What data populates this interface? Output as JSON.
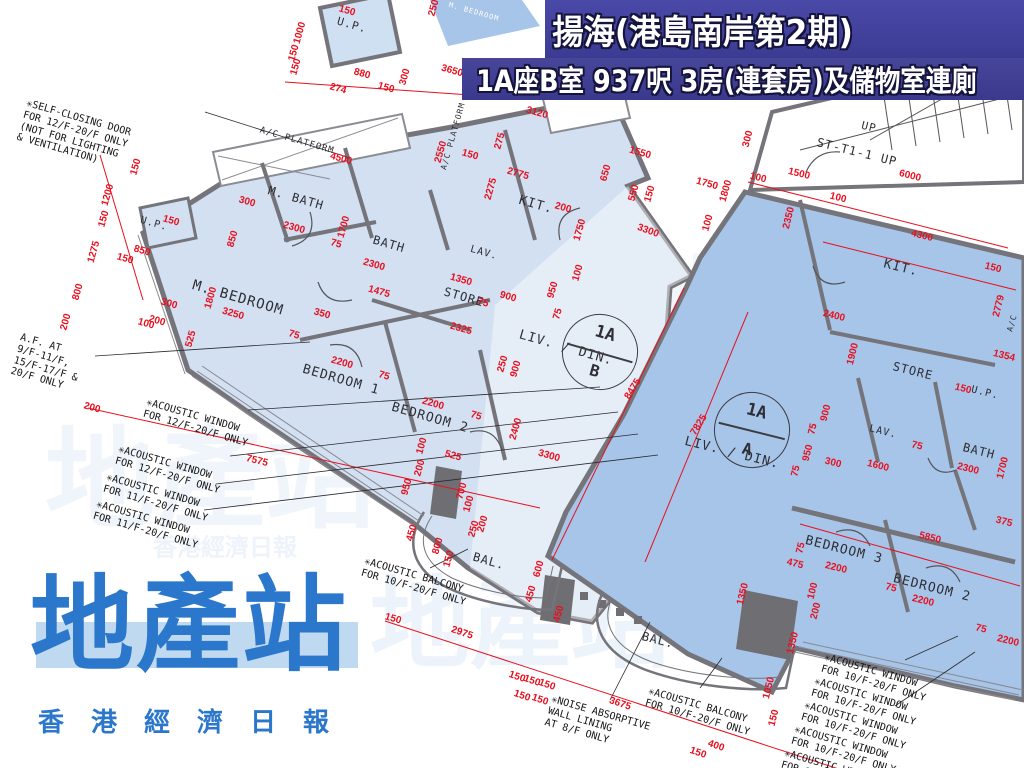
{
  "banner": {
    "title_line1": "揚海(港島南岸第2期)",
    "title_line2": "1A座B室 937呎 3房(連套房)及儲物室連廁"
  },
  "logo": {
    "name": "地產站",
    "tagline": "香港經濟日報"
  },
  "colors": {
    "banner_bg": "#44439c",
    "dimension_red": "#e8101e",
    "wall_gray": "#74747a",
    "unit_b_fill": "#d2e0f2",
    "unit_a_fill": "#a6c5e8",
    "logo_blue": "#2b77cb"
  },
  "unit_circles": [
    {
      "line1": "1A",
      "line2": "B",
      "x": 600,
      "y": 352,
      "r": 16
    },
    {
      "line1": "1A",
      "line2": "A",
      "x": 752,
      "y": 430,
      "r": 14
    }
  ],
  "rooms": [
    {
      "label": "U.P.",
      "x": 352,
      "y": 25,
      "r": 16,
      "s": 11
    },
    {
      "label": "A/C PLATFORM",
      "x": 297,
      "y": 141,
      "r": 16,
      "s": 9
    },
    {
      "label": "A/C PLATFORM",
      "x": 453,
      "y": 136,
      "r": -74,
      "s": 8
    },
    {
      "label": "M. BATH",
      "x": 296,
      "y": 198,
      "r": 16,
      "s": 12
    },
    {
      "label": "KIT.",
      "x": 536,
      "y": 205,
      "r": 16,
      "s": 13
    },
    {
      "label": "BATH",
      "x": 389,
      "y": 244,
      "r": 16,
      "s": 12
    },
    {
      "label": "LAV.",
      "x": 484,
      "y": 253,
      "r": 16,
      "s": 10
    },
    {
      "label": "STORE",
      "x": 464,
      "y": 297,
      "r": 16,
      "s": 12
    },
    {
      "label": "M. BEDROOM",
      "x": 238,
      "y": 298,
      "r": 16,
      "s": 14
    },
    {
      "label": "BEDROOM 1",
      "x": 341,
      "y": 380,
      "r": 16,
      "s": 13
    },
    {
      "label": "BEDROOM 2",
      "x": 430,
      "y": 418,
      "r": 16,
      "s": 13
    },
    {
      "label": "LIV. / DIN.",
      "x": 566,
      "y": 348,
      "r": 16,
      "s": 13
    },
    {
      "label": "BAL.",
      "x": 489,
      "y": 561,
      "r": 16,
      "s": 12
    },
    {
      "label": "U.P.",
      "x": 154,
      "y": 224,
      "r": 16,
      "s": 10
    },
    {
      "label": "UP",
      "x": 869,
      "y": 127,
      "r": 14,
      "s": 11
    },
    {
      "label": "ST-T1-1 UP",
      "x": 857,
      "y": 152,
      "r": 14,
      "s": 12
    },
    {
      "label": "KIT.",
      "x": 901,
      "y": 268,
      "r": 14,
      "s": 13
    },
    {
      "label": "STORE",
      "x": 913,
      "y": 371,
      "r": 14,
      "s": 12
    },
    {
      "label": "LAV.",
      "x": 883,
      "y": 432,
      "r": 14,
      "s": 10
    },
    {
      "label": "U.P.",
      "x": 985,
      "y": 393,
      "r": 14,
      "s": 10
    },
    {
      "label": "BATH",
      "x": 979,
      "y": 451,
      "r": 14,
      "s": 12
    },
    {
      "label": "BEDROOM 3",
      "x": 844,
      "y": 550,
      "r": 14,
      "s": 13
    },
    {
      "label": "BEDROOM 2",
      "x": 932,
      "y": 588,
      "r": 14,
      "s": 13
    },
    {
      "label": "LIV. / DIN.",
      "x": 732,
      "y": 453,
      "r": 14,
      "s": 13
    },
    {
      "label": "BAL.",
      "x": 658,
      "y": 640,
      "r": 14,
      "s": 12
    },
    {
      "label": "A/C",
      "x": 1012,
      "y": 323,
      "r": -74,
      "s": 8
    },
    {
      "label": "M. BEDROOM",
      "x": 474,
      "y": 12,
      "r": 16,
      "s": 7,
      "c": "#ffffff"
    }
  ],
  "annotations": [
    {
      "text": "✳SELF-CLOSING DOOR\nFOR 12/F-20/F ONLY\n(NOT FOR LIGHTING\n& VENTILATION)",
      "x": 28,
      "y": 98,
      "r": 16
    },
    {
      "text": "A.F. AT\n9/F-11/F,\n15/F-17/F &\n20/F ONLY",
      "x": 22,
      "y": 332,
      "r": 16
    },
    {
      "text": "✳ACOUSTIC WINDOW\nFOR 12/F-20/F ONLY",
      "x": 148,
      "y": 397,
      "r": 16
    },
    {
      "text": "✳ACOUSTIC WINDOW\nFOR 12/F-20/F ONLY",
      "x": 120,
      "y": 444,
      "r": 16
    },
    {
      "text": "✳ACOUSTIC WINDOW\nFOR 11/F-20/F ONLY",
      "x": 108,
      "y": 472,
      "r": 16
    },
    {
      "text": "✳ACOUSTIC WINDOW\nFOR 11/F-20/F ONLY",
      "x": 98,
      "y": 499,
      "r": 16
    },
    {
      "text": "✳ACOUSTIC BALCONY\nFOR 10/F-20/F ONLY",
      "x": 366,
      "y": 556,
      "r": 16
    },
    {
      "text": "✳NOISE ABSORPTIVE\nWALL LINING\nAT 8/F ONLY",
      "x": 553,
      "y": 694,
      "r": 16
    },
    {
      "text": "✳ACOUSTIC BALCONY\nFOR 10/F-20/F ONLY",
      "x": 650,
      "y": 686,
      "r": 16
    },
    {
      "text": "✳ACOUSTIC WINDOW\nFOR 10/F-20/F ONLY",
      "x": 826,
      "y": 652,
      "r": 16
    },
    {
      "text": "✳ACOUSTIC WINDOW\nFOR 10/F-20/F ONLY",
      "x": 816,
      "y": 676,
      "r": 16
    },
    {
      "text": "✳ACOUSTIC WINDOW\nFOR 10/F-20/F ONLY",
      "x": 806,
      "y": 700,
      "r": 16
    },
    {
      "text": "✳ACOUSTIC WINDOW\nFOR 10/F-20/F ONLY",
      "x": 796,
      "y": 724,
      "r": 16
    },
    {
      "text": "✳ACOUSTIC WINDOW\nFOR 10/F-20/F ONLY",
      "x": 786,
      "y": 748,
      "r": 16
    }
  ],
  "dims": [
    {
      "t": "150",
      "x": 347,
      "y": 11,
      "r": 16
    },
    {
      "t": "250",
      "x": 434,
      "y": 8,
      "r": -74
    },
    {
      "t": "1000",
      "x": 300,
      "y": 33,
      "r": -74
    },
    {
      "t": "150",
      "x": 294,
      "y": 53,
      "r": -74
    },
    {
      "t": "150",
      "x": 296,
      "y": 67,
      "r": -74
    },
    {
      "t": "880",
      "x": 362,
      "y": 74,
      "r": 16
    },
    {
      "t": "274",
      "x": 338,
      "y": 89,
      "r": 16
    },
    {
      "t": "150",
      "x": 386,
      "y": 88,
      "r": 16
    },
    {
      "t": "300",
      "x": 405,
      "y": 77,
      "r": -74
    },
    {
      "t": "3650",
      "x": 452,
      "y": 71,
      "r": 16
    },
    {
      "t": "2550",
      "x": 441,
      "y": 152,
      "r": -74
    },
    {
      "t": "4500",
      "x": 341,
      "y": 159,
      "r": 16
    },
    {
      "t": "3120",
      "x": 537,
      "y": 113,
      "r": 16
    },
    {
      "t": "150",
      "x": 470,
      "y": 155,
      "r": 16
    },
    {
      "t": "275",
      "x": 500,
      "y": 141,
      "r": -74
    },
    {
      "t": "2775",
      "x": 518,
      "y": 174,
      "r": 16
    },
    {
      "t": "2275",
      "x": 491,
      "y": 189,
      "r": -74
    },
    {
      "t": "1550",
      "x": 640,
      "y": 153,
      "r": 16
    },
    {
      "t": "650",
      "x": 606,
      "y": 173,
      "r": -74
    },
    {
      "t": "550",
      "x": 634,
      "y": 193,
      "r": -74
    },
    {
      "t": "150",
      "x": 650,
      "y": 194,
      "r": -74
    },
    {
      "t": "1750",
      "x": 707,
      "y": 184,
      "r": 16
    },
    {
      "t": "1800",
      "x": 726,
      "y": 191,
      "r": -74
    },
    {
      "t": "100",
      "x": 708,
      "y": 223,
      "r": -74
    },
    {
      "t": "3300",
      "x": 648,
      "y": 231,
      "r": 20
    },
    {
      "t": "200",
      "x": 563,
      "y": 208,
      "r": 16
    },
    {
      "t": "1750",
      "x": 580,
      "y": 230,
      "r": -74
    },
    {
      "t": "150",
      "x": 136,
      "y": 167,
      "r": -74
    },
    {
      "t": "1200",
      "x": 108,
      "y": 195,
      "r": -74
    },
    {
      "t": "150",
      "x": 104,
      "y": 219,
      "r": -74
    },
    {
      "t": "1275",
      "x": 94,
      "y": 252,
      "r": -74
    },
    {
      "t": "800",
      "x": 78,
      "y": 292,
      "r": -74
    },
    {
      "t": "850",
      "x": 142,
      "y": 251,
      "r": 16
    },
    {
      "t": "150",
      "x": 125,
      "y": 259,
      "r": 16
    },
    {
      "t": "150",
      "x": 171,
      "y": 221,
      "r": 16
    },
    {
      "t": "200",
      "x": 66,
      "y": 322,
      "r": -74
    },
    {
      "t": "300",
      "x": 169,
      "y": 304,
      "r": 16
    },
    {
      "t": "200",
      "x": 157,
      "y": 321,
      "r": 16
    },
    {
      "t": "100",
      "x": 146,
      "y": 324,
      "r": 16
    },
    {
      "t": "200",
      "x": 92,
      "y": 408,
      "r": 16
    },
    {
      "t": "7575",
      "x": 257,
      "y": 461,
      "r": 14
    },
    {
      "t": "850",
      "x": 233,
      "y": 239,
      "r": -74
    },
    {
      "t": "300",
      "x": 247,
      "y": 202,
      "r": 16
    },
    {
      "t": "2300",
      "x": 294,
      "y": 228,
      "r": 16
    },
    {
      "t": "1700",
      "x": 344,
      "y": 227,
      "r": -74
    },
    {
      "t": "75",
      "x": 336,
      "y": 244,
      "r": 16
    },
    {
      "t": "2300",
      "x": 374,
      "y": 265,
      "r": 16
    },
    {
      "t": "1475",
      "x": 379,
      "y": 292,
      "r": 16
    },
    {
      "t": "3250",
      "x": 233,
      "y": 314,
      "r": 16
    },
    {
      "t": "1800",
      "x": 211,
      "y": 298,
      "r": -74
    },
    {
      "t": "525",
      "x": 191,
      "y": 339,
      "r": -74
    },
    {
      "t": "350",
      "x": 322,
      "y": 314,
      "r": 16
    },
    {
      "t": "75",
      "x": 294,
      "y": 335,
      "r": 16
    },
    {
      "t": "1350",
      "x": 461,
      "y": 280,
      "r": 16
    },
    {
      "t": "75",
      "x": 483,
      "y": 303,
      "r": 16
    },
    {
      "t": "900",
      "x": 508,
      "y": 297,
      "r": 16
    },
    {
      "t": "2325",
      "x": 461,
      "y": 329,
      "r": 16
    },
    {
      "t": "950",
      "x": 553,
      "y": 290,
      "r": -74
    },
    {
      "t": "75",
      "x": 558,
      "y": 314,
      "r": -74
    },
    {
      "t": "100",
      "x": 578,
      "y": 273,
      "r": -74
    },
    {
      "t": "2200",
      "x": 342,
      "y": 363,
      "r": 16
    },
    {
      "t": "75",
      "x": 384,
      "y": 376,
      "r": 16
    },
    {
      "t": "2200",
      "x": 433,
      "y": 404,
      "r": 16
    },
    {
      "t": "75",
      "x": 476,
      "y": 416,
      "r": 16
    },
    {
      "t": "250",
      "x": 503,
      "y": 364,
      "r": -74
    },
    {
      "t": "900",
      "x": 516,
      "y": 369,
      "r": -74
    },
    {
      "t": "2400",
      "x": 516,
      "y": 429,
      "r": -74
    },
    {
      "t": "525",
      "x": 453,
      "y": 456,
      "r": 16
    },
    {
      "t": "100",
      "x": 422,
      "y": 446,
      "r": -74
    },
    {
      "t": "200",
      "x": 420,
      "y": 468,
      "r": -74
    },
    {
      "t": "950",
      "x": 407,
      "y": 487,
      "r": -74
    },
    {
      "t": "700",
      "x": 462,
      "y": 491,
      "r": -74
    },
    {
      "t": "100",
      "x": 469,
      "y": 504,
      "r": -74
    },
    {
      "t": "8475",
      "x": 633,
      "y": 389,
      "r": -58
    },
    {
      "t": "7825",
      "x": 699,
      "y": 425,
      "r": -58
    },
    {
      "t": "3300",
      "x": 549,
      "y": 456,
      "r": 16
    },
    {
      "t": "450",
      "x": 412,
      "y": 533,
      "r": -74
    },
    {
      "t": "800",
      "x": 438,
      "y": 546,
      "r": -74
    },
    {
      "t": "150",
      "x": 449,
      "y": 559,
      "r": -74
    },
    {
      "t": "250",
      "x": 474,
      "y": 529,
      "r": -74
    },
    {
      "t": "200",
      "x": 483,
      "y": 524,
      "r": -74
    },
    {
      "t": "600",
      "x": 539,
      "y": 569,
      "r": -74
    },
    {
      "t": "450",
      "x": 531,
      "y": 594,
      "r": -74
    },
    {
      "t": "450",
      "x": 559,
      "y": 614,
      "r": -74
    },
    {
      "t": "150",
      "x": 393,
      "y": 619,
      "r": 16
    },
    {
      "t": "2975",
      "x": 462,
      "y": 633,
      "r": 19
    },
    {
      "t": "150",
      "x": 517,
      "y": 677,
      "r": 19
    },
    {
      "t": "150",
      "x": 532,
      "y": 681,
      "r": 19
    },
    {
      "t": "150",
      "x": 547,
      "y": 685,
      "r": 19
    },
    {
      "t": "150",
      "x": 522,
      "y": 696,
      "r": 19
    },
    {
      "t": "150",
      "x": 540,
      "y": 700,
      "r": 19
    },
    {
      "t": "3675",
      "x": 620,
      "y": 704,
      "r": 19
    },
    {
      "t": "400",
      "x": 716,
      "y": 746,
      "r": 19
    },
    {
      "t": "150",
      "x": 698,
      "y": 753,
      "r": 19
    },
    {
      "t": "300",
      "x": 748,
      "y": 139,
      "r": -76
    },
    {
      "t": "100",
      "x": 758,
      "y": 178,
      "r": 14
    },
    {
      "t": "1500",
      "x": 799,
      "y": 174,
      "r": 14
    },
    {
      "t": "6000",
      "x": 910,
      "y": 176,
      "r": 14
    },
    {
      "t": "100",
      "x": 838,
      "y": 198,
      "r": 14
    },
    {
      "t": "2350",
      "x": 789,
      "y": 218,
      "r": -76
    },
    {
      "t": "4300",
      "x": 922,
      "y": 236,
      "r": 14
    },
    {
      "t": "150",
      "x": 993,
      "y": 268,
      "r": 14
    },
    {
      "t": "2779",
      "x": 999,
      "y": 306,
      "r": -76
    },
    {
      "t": "1354",
      "x": 1004,
      "y": 356,
      "r": 14
    },
    {
      "t": "2400",
      "x": 834,
      "y": 316,
      "r": 14
    },
    {
      "t": "1900",
      "x": 853,
      "y": 354,
      "r": -76
    },
    {
      "t": "150",
      "x": 963,
      "y": 389,
      "r": 14
    },
    {
      "t": "900",
      "x": 826,
      "y": 413,
      "r": -76
    },
    {
      "t": "75",
      "x": 813,
      "y": 429,
      "r": -76
    },
    {
      "t": "950",
      "x": 808,
      "y": 453,
      "r": -76
    },
    {
      "t": "75",
      "x": 796,
      "y": 471,
      "r": -76
    },
    {
      "t": "300",
      "x": 833,
      "y": 463,
      "r": 14
    },
    {
      "t": "1600",
      "x": 878,
      "y": 466,
      "r": 14
    },
    {
      "t": "75",
      "x": 917,
      "y": 446,
      "r": 14
    },
    {
      "t": "2300",
      "x": 968,
      "y": 469,
      "r": 14
    },
    {
      "t": "1700",
      "x": 1003,
      "y": 468,
      "r": -76
    },
    {
      "t": "375",
      "x": 1004,
      "y": 522,
      "r": 14
    },
    {
      "t": "5850",
      "x": 930,
      "y": 538,
      "r": 14
    },
    {
      "t": "75",
      "x": 801,
      "y": 548,
      "r": -76
    },
    {
      "t": "2200",
      "x": 836,
      "y": 568,
      "r": 14
    },
    {
      "t": "475",
      "x": 795,
      "y": 564,
      "r": 14
    },
    {
      "t": "75",
      "x": 891,
      "y": 588,
      "r": 14
    },
    {
      "t": "2200",
      "x": 923,
      "y": 601,
      "r": 14
    },
    {
      "t": "75",
      "x": 981,
      "y": 629,
      "r": 14
    },
    {
      "t": "2200",
      "x": 1008,
      "y": 641,
      "r": 14
    },
    {
      "t": "1350",
      "x": 743,
      "y": 594,
      "r": -76
    },
    {
      "t": "100",
      "x": 813,
      "y": 591,
      "r": -76
    },
    {
      "t": "200",
      "x": 816,
      "y": 611,
      "r": -76
    },
    {
      "t": "1350",
      "x": 793,
      "y": 643,
      "r": -76
    },
    {
      "t": "1050",
      "x": 769,
      "y": 688,
      "r": -76
    },
    {
      "t": "150",
      "x": 774,
      "y": 718,
      "r": -76
    }
  ],
  "watermarks": [
    {
      "text": "地產站",
      "x": 210,
      "y": 470,
      "s": 110,
      "o": 0.09
    },
    {
      "text": "地產站",
      "x": 520,
      "y": 615,
      "s": 100,
      "o": 0.1
    },
    {
      "text": "地產站",
      "x": 790,
      "y": 300,
      "s": 110,
      "o": 0.08
    },
    {
      "text": "香港經濟日報",
      "x": 225,
      "y": 545,
      "s": 24,
      "o": 0.1
    },
    {
      "text": "香港經濟日報",
      "x": 800,
      "y": 380,
      "s": 22,
      "o": 0.08
    }
  ]
}
